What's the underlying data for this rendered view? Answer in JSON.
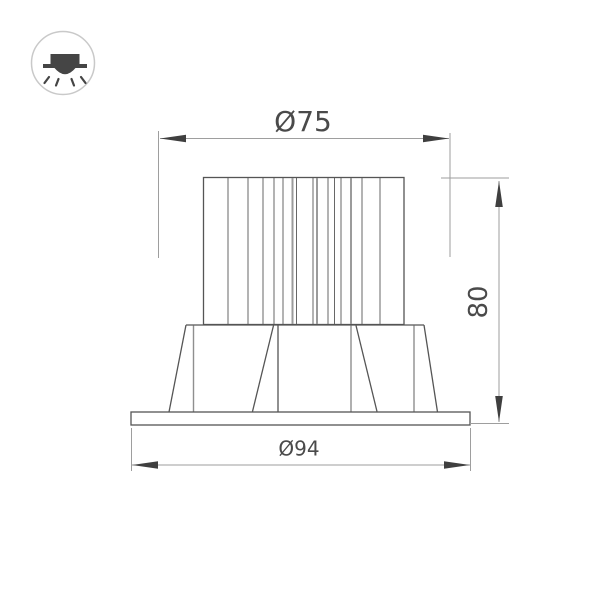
{
  "icon": {
    "name": "recessed-downlight-icon"
  },
  "drawing": {
    "dimensions": {
      "top_diameter": {
        "label": "Ø75",
        "value": 75
      },
      "height": {
        "label": "80",
        "value": 80
      },
      "flange_diameter": {
        "label": "Ø94",
        "value": 94
      }
    },
    "colors": {
      "outline": "#555555",
      "fin_line": "#676767",
      "dimension_line": "#9e9e9e",
      "arrow": "#3f3f3f",
      "text": "#4a4a4a",
      "icon_ring": "#c9c9c9",
      "icon_glyph": "#454545",
      "background": "#ffffff"
    }
  }
}
